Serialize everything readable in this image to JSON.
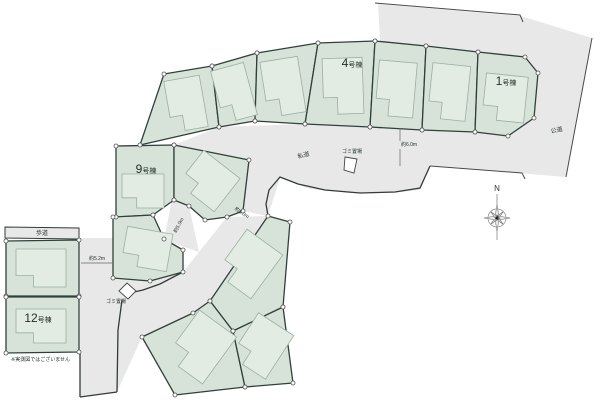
{
  "plan": {
    "width": 600,
    "height": 403,
    "colors": {
      "background": "#ffffff",
      "road_fill": "#e8e8e8",
      "lot_fill": "#d7e3d8",
      "lot_stroke": "#30403a",
      "house_fill": "#e3ece3",
      "house_stroke": "#9bafa1",
      "thin_line": "#4a4a4a",
      "text": "#1f2d26",
      "vertex_fill": "#ffffff",
      "vertex_stroke": "#555555"
    },
    "roads": [
      {
        "name": "public-road-area",
        "points": [
          [
            378,
            4
          ],
          [
            521,
            16
          ],
          [
            592,
            38
          ],
          [
            566,
            177
          ],
          [
            430,
            166
          ],
          [
            412,
            130
          ],
          [
            380,
            40
          ]
        ]
      },
      {
        "name": "private-road-upper-band",
        "points": [
          [
            174,
            145
          ],
          [
            219,
            127
          ],
          [
            300,
            124
          ],
          [
            370,
            127
          ],
          [
            422,
            130
          ],
          [
            478,
            133
          ],
          [
            515,
            137
          ],
          [
            532,
            160
          ],
          [
            524,
            173
          ],
          [
            430,
            166
          ],
          [
            420,
            190
          ],
          [
            390,
            193
          ],
          [
            350,
            193
          ],
          [
            310,
            189
          ],
          [
            280,
            178
          ],
          [
            268,
            216
          ],
          [
            243,
            211
          ],
          [
            249,
            160
          ]
        ]
      },
      {
        "name": "private-road-lower-band",
        "points": [
          [
            80,
            238
          ],
          [
            113,
            238
          ],
          [
            113,
            278
          ],
          [
            183,
            272
          ],
          [
            199,
            252
          ],
          [
            227,
            217
          ],
          [
            268,
            216
          ],
          [
            210,
            301
          ],
          [
            193,
            313
          ],
          [
            142,
            337
          ],
          [
            117,
            392
          ],
          [
            80,
            397
          ]
        ]
      },
      {
        "name": "stub-road",
        "points": [
          [
            172,
            199
          ],
          [
            189,
            206
          ],
          [
            199,
            252
          ],
          [
            164,
            240
          ]
        ]
      }
    ],
    "sidewalk": {
      "label": "歩道",
      "points": [
        [
          5,
          227
        ],
        [
          79,
          228
        ],
        [
          79,
          239
        ],
        [
          5,
          238
        ]
      ],
      "label_pos": [
        42,
        235
      ]
    },
    "lots": [
      {
        "name": "lot-fan-1",
        "label": null,
        "points": [
          [
            164,
            74
          ],
          [
            212,
            66
          ],
          [
            219,
            127
          ],
          [
            140,
            145
          ]
        ]
      },
      {
        "name": "lot-fan-2",
        "label": null,
        "points": [
          [
            212,
            66
          ],
          [
            257,
            53
          ],
          [
            255,
            121
          ],
          [
            219,
            127
          ]
        ]
      },
      {
        "name": "lot-fan-3",
        "label": null,
        "points": [
          [
            257,
            53
          ],
          [
            318,
            43
          ],
          [
            305,
            124
          ],
          [
            255,
            121
          ]
        ]
      },
      {
        "name": "lot-4",
        "label": "4号棟",
        "num": "4",
        "suffix": "号棟",
        "label_pos": [
          352,
          67
        ],
        "points": [
          [
            318,
            43
          ],
          [
            375,
            41
          ],
          [
            370,
            127
          ],
          [
            305,
            124
          ]
        ]
      },
      {
        "name": "lot-fan-5",
        "label": null,
        "points": [
          [
            375,
            41
          ],
          [
            426,
            46
          ],
          [
            422,
            130
          ],
          [
            370,
            127
          ]
        ]
      },
      {
        "name": "lot-fan-6",
        "label": null,
        "points": [
          [
            426,
            46
          ],
          [
            478,
            52
          ],
          [
            475,
            132
          ],
          [
            422,
            130
          ]
        ]
      },
      {
        "name": "lot-1",
        "label": "1号棟",
        "num": "1",
        "suffix": "号棟",
        "label_pos": [
          506,
          85
        ],
        "points": [
          [
            478,
            52
          ],
          [
            525,
            57
          ],
          [
            538,
            73
          ],
          [
            534,
            118
          ],
          [
            508,
            136
          ],
          [
            475,
            132
          ]
        ]
      },
      {
        "name": "lot-9",
        "label": "9号棟",
        "num": "9",
        "suffix": "号棟",
        "label_pos": [
          146,
          173
        ],
        "points": [
          [
            116,
            146
          ],
          [
            174,
            145
          ],
          [
            174,
            200
          ],
          [
            153,
            215
          ],
          [
            116,
            217
          ]
        ]
      },
      {
        "name": "lot-mid-right",
        "label": null,
        "points": [
          [
            174,
            145
          ],
          [
            249,
            160
          ],
          [
            243,
            211
          ],
          [
            227,
            217
          ],
          [
            205,
            220
          ],
          [
            189,
            206
          ],
          [
            174,
            200
          ]
        ]
      },
      {
        "name": "lot-below-9",
        "label": null,
        "points": [
          [
            113,
            217
          ],
          [
            153,
            215
          ],
          [
            164,
            239
          ],
          [
            183,
            250
          ],
          [
            183,
            272
          ],
          [
            150,
            281
          ],
          [
            113,
            278
          ]
        ]
      },
      {
        "name": "lot-left-upper",
        "label": null,
        "points": [
          [
            6,
            241
          ],
          [
            79,
            240
          ],
          [
            79,
            296
          ],
          [
            6,
            296
          ]
        ]
      },
      {
        "name": "lot-12",
        "label": "12号棟",
        "num": "12",
        "suffix": "号棟",
        "label_pos": [
          38,
          322
        ],
        "points": [
          [
            6,
            297
          ],
          [
            79,
            297
          ],
          [
            79,
            352
          ],
          [
            6,
            353
          ]
        ]
      },
      {
        "name": "lot-bottom-top",
        "label": null,
        "points": [
          [
            268,
            216
          ],
          [
            290,
            222
          ],
          [
            283,
            307
          ],
          [
            233,
            331
          ],
          [
            210,
            301
          ]
        ]
      },
      {
        "name": "lot-bottom-left",
        "label": null,
        "points": [
          [
            210,
            301
          ],
          [
            233,
            331
          ],
          [
            245,
            387
          ],
          [
            175,
            395
          ],
          [
            142,
            337
          ],
          [
            193,
            313
          ]
        ]
      },
      {
        "name": "lot-bottom-right",
        "label": null,
        "points": [
          [
            233,
            331
          ],
          [
            283,
            307
          ],
          [
            293,
            383
          ],
          [
            245,
            387
          ]
        ]
      }
    ],
    "houses": [
      {
        "cx": 186,
        "cy": 104,
        "w": 36,
        "h": 52,
        "rot": -10
      },
      {
        "cx": 234,
        "cy": 93,
        "w": 34,
        "h": 54,
        "rot": -15
      },
      {
        "cx": 283,
        "cy": 87,
        "w": 38,
        "h": 56,
        "rot": -9
      },
      {
        "cx": 343,
        "cy": 86,
        "w": 40,
        "h": 56,
        "rot": -2
      },
      {
        "cx": 396,
        "cy": 89,
        "w": 38,
        "h": 55,
        "rot": 5
      },
      {
        "cx": 449,
        "cy": 92,
        "w": 38,
        "h": 55,
        "rot": 6
      },
      {
        "cx": 505,
        "cy": 98,
        "w": 42,
        "h": 46,
        "rot": 6
      },
      {
        "cx": 143,
        "cy": 191,
        "w": 42,
        "h": 34,
        "rot": 0
      },
      {
        "cx": 209,
        "cy": 181,
        "w": 46,
        "h": 42,
        "rot": 38
      },
      {
        "cx": 147,
        "cy": 249,
        "w": 46,
        "h": 38,
        "rot": 10
      },
      {
        "cx": 41,
        "cy": 268,
        "w": 50,
        "h": 38,
        "rot": 0
      },
      {
        "cx": 41,
        "cy": 326,
        "w": 50,
        "h": 34,
        "rot": 0
      },
      {
        "cx": 249,
        "cy": 264,
        "w": 44,
        "h": 54,
        "rot": 36
      },
      {
        "cx": 201,
        "cy": 347,
        "w": 46,
        "h": 58,
        "rot": 36
      },
      {
        "cx": 262,
        "cy": 346,
        "w": 42,
        "h": 52,
        "rot": 33
      }
    ],
    "road_edges": [
      [
        [
          430,
          166
        ],
        [
          420,
          188
        ],
        [
          395,
          192
        ],
        [
          360,
          193
        ],
        [
          325,
          190
        ],
        [
          298,
          184
        ],
        [
          280,
          177
        ],
        [
          269,
          190
        ],
        [
          266,
          204
        ],
        [
          268,
          216
        ]
      ],
      [
        [
          183,
          272
        ],
        [
          160,
          284
        ],
        [
          143,
          290
        ],
        [
          134,
          292
        ]
      ],
      [
        [
          122,
          300
        ],
        [
          118,
          330
        ],
        [
          117,
          392
        ]
      ],
      [
        [
          80,
          397
        ],
        [
          117,
          392
        ]
      ],
      [
        [
          80,
          353
        ],
        [
          80,
          397
        ]
      ]
    ],
    "boundary_lines": [
      [
        [
          375,
          3
        ],
        [
          520,
          15
        ],
        [
          523,
          22
        ]
      ],
      [
        [
          430,
          166
        ],
        [
          522,
          173
        ],
        [
          525,
          179
        ]
      ],
      [
        [
          592,
          38
        ],
        [
          566,
          177
        ]
      ]
    ],
    "dim_lines": [
      [
        [
          400,
          128
        ],
        [
          400,
          141
        ]
      ],
      [
        [
          400,
          149
        ],
        [
          400,
          166
        ]
      ],
      [
        [
          81,
          263
        ],
        [
          112,
          263
        ]
      ]
    ],
    "garbage_spots": [
      {
        "label": "ゴミ置場",
        "points": [
          [
            345,
            157
          ],
          [
            357,
            159
          ],
          [
            354,
            173
          ],
          [
            344,
            170
          ]
        ],
        "label_pos": [
          352,
          153
        ],
        "label_rot": 0
      },
      {
        "label": "ゴミ置場",
        "points": [
          [
            127,
            283
          ],
          [
            136,
            291
          ],
          [
            128,
            299
          ],
          [
            119,
            291
          ]
        ],
        "label_pos": [
          116,
          303
        ],
        "label_rot": 0
      }
    ],
    "labels": [
      {
        "name": "label-private-road",
        "text": "私道",
        "x": 304,
        "y": 157,
        "size": 6,
        "rot": -14
      },
      {
        "name": "label-public-road",
        "text": "公道",
        "x": 557,
        "y": 132,
        "size": 6,
        "rot": -12
      },
      {
        "name": "label-dim-6m",
        "text": "約6.0m",
        "x": 409,
        "y": 146,
        "size": 5,
        "rot": 0
      },
      {
        "name": "label-dim-5-2m",
        "text": "約5.2m",
        "x": 97,
        "y": 260,
        "size": 5,
        "rot": 0
      },
      {
        "name": "label-dim-5m-a",
        "text": "約5.0m",
        "x": 180,
        "y": 226,
        "size": 5,
        "rot": -62
      },
      {
        "name": "label-dim-5m-b",
        "text": "約5.0m",
        "x": 241,
        "y": 214,
        "size": 5,
        "rot": 33
      },
      {
        "name": "disclaimer",
        "text": "※実測図ではございません",
        "x": 11,
        "y": 361,
        "size": 5,
        "rot": 0,
        "anchor": "start"
      }
    ],
    "compass": {
      "letter": "N",
      "x": 497,
      "y": 218
    }
  }
}
